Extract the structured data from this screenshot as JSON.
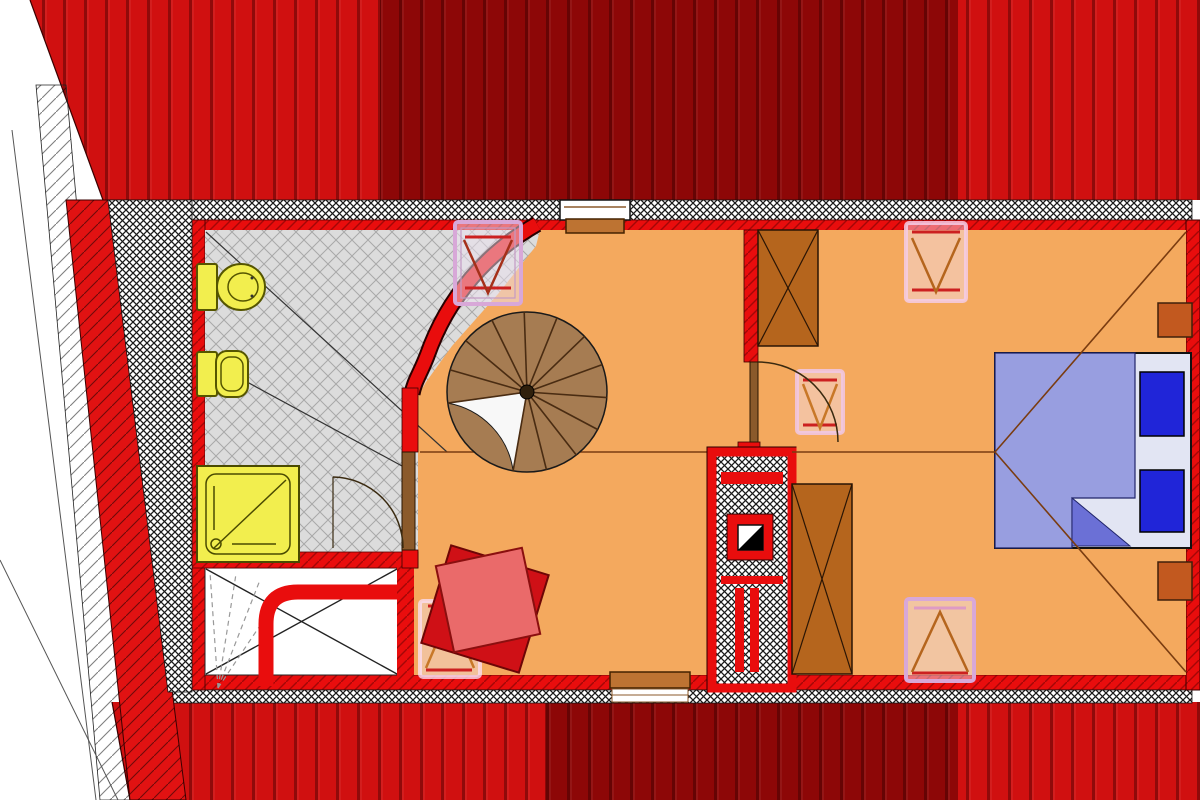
{
  "document": {
    "type": "architectural-floor-plan",
    "view": "attic-storey-top-view",
    "visible_text": ""
  },
  "palette": {
    "roof_bright": "#d01010",
    "roof_dark": "#8d0707",
    "wall_red": "#e90d0d",
    "gable_red": "#e11212",
    "floor_orange": "#f4a95e",
    "floor_gray": "#dcdcdc",
    "fixture_yellow": "#f2ee4e",
    "fixture_outline": "#5a5a00",
    "stair_tan": "#a67c52",
    "stair_line": "#4a2c12",
    "wardrobe_brown": "#b5651d",
    "door_brown": "#8b5a2b",
    "window_brown": "#bd7332",
    "bed_blanket": "#989ee0",
    "bed_blanket_dark": "#6b70d6",
    "bed_mattress": "#e2e5f3",
    "pillow_blue": "#2025d8",
    "nightstand_brown": "#c2591f",
    "skylight_pink": "#d8a8d8",
    "skylight_bar_red": "#cc2020",
    "skylight_triangle": "#b5651d",
    "chair_dark_red": "#cf1016",
    "chair_light_red": "#ea6a6a",
    "ceiling_line_brown": "#7a3c10"
  },
  "plan": {
    "rooms": [
      {
        "name": "bathroom",
        "floor": "gray-diamond-tile"
      },
      {
        "name": "hall-landing",
        "floor": "orange"
      },
      {
        "name": "bedroom",
        "floor": "orange"
      },
      {
        "name": "stair-void",
        "floor": "white"
      }
    ],
    "fixtures": [
      "toilet",
      "bidet",
      "shower-tray",
      "spiral-staircase",
      "chimney-shaft"
    ],
    "furniture": [
      "double-bed",
      "pillows",
      "nightstands",
      "wardrobe-top",
      "wardrobe-center",
      "armchair"
    ],
    "openings": {
      "roof_windows": 5,
      "wall_windows": 2,
      "doors": 2
    },
    "staircase": {
      "type": "spiral",
      "visible_treads": 12
    }
  }
}
